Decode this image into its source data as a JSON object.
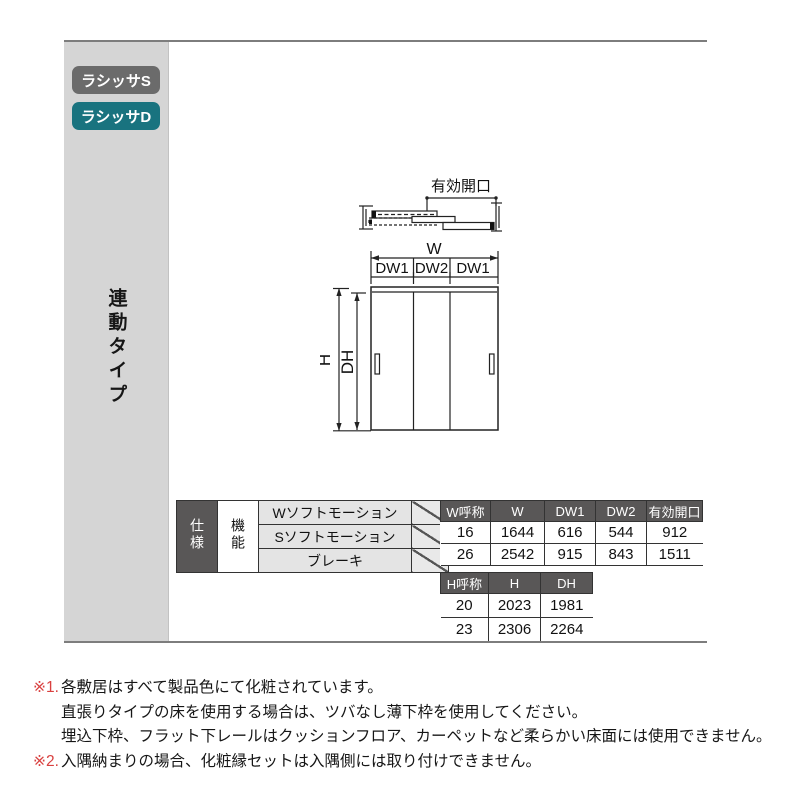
{
  "badges": [
    {
      "label": "ラシッサS",
      "color": "#6b6b6b"
    },
    {
      "label": "ラシッサD",
      "color": "#19737f"
    }
  ],
  "side_label": "連動タイプ",
  "diagram": {
    "plan_dim_label": "有効開口",
    "width_dim_label": "W",
    "panel_dims": [
      "DW1",
      "DW2",
      "DW1"
    ],
    "height_dim_label": "H",
    "door_height_dim_label": "DH"
  },
  "spec_table": {
    "row_header": "仕様",
    "col_header": "機能",
    "functions": [
      "Wソフトモーション",
      "Sソフトモーション",
      "ブレーキ"
    ]
  },
  "w_table": {
    "headers": [
      "W呼称",
      "W",
      "DW1",
      "DW2",
      "有効開口"
    ],
    "rows": [
      [
        "16",
        "1644",
        "616",
        "544",
        "912"
      ],
      [
        "26",
        "2542",
        "915",
        "843",
        "1511"
      ]
    ]
  },
  "h_table": {
    "headers": [
      "H呼称",
      "H",
      "DH"
    ],
    "rows": [
      [
        "20",
        "2023",
        "1981"
      ],
      [
        "23",
        "2306",
        "2264"
      ]
    ]
  },
  "notes": [
    {
      "prefix": "※1.",
      "text": "各敷居はすべて製品色にて化粧されています。"
    },
    {
      "prefix": "",
      "text": "直張りタイプの床を使用する場合は、ツバなし薄下枠を使用してください。"
    },
    {
      "prefix": "",
      "text": "埋込下枠、フラット下レールはクッションフロア、カーペットなど柔らかい床面には使用できません。"
    },
    {
      "prefix": "※2.",
      "text": "入隅納まりの場合、化粧縁セットは入隅側には取り付けできません。"
    }
  ],
  "colors": {
    "badge_gray": "#6b6b6b",
    "badge_teal": "#19737f",
    "table_header_bg": "#595757",
    "note_red": "#d9403f",
    "strip_gray": "#d5d5d5"
  }
}
